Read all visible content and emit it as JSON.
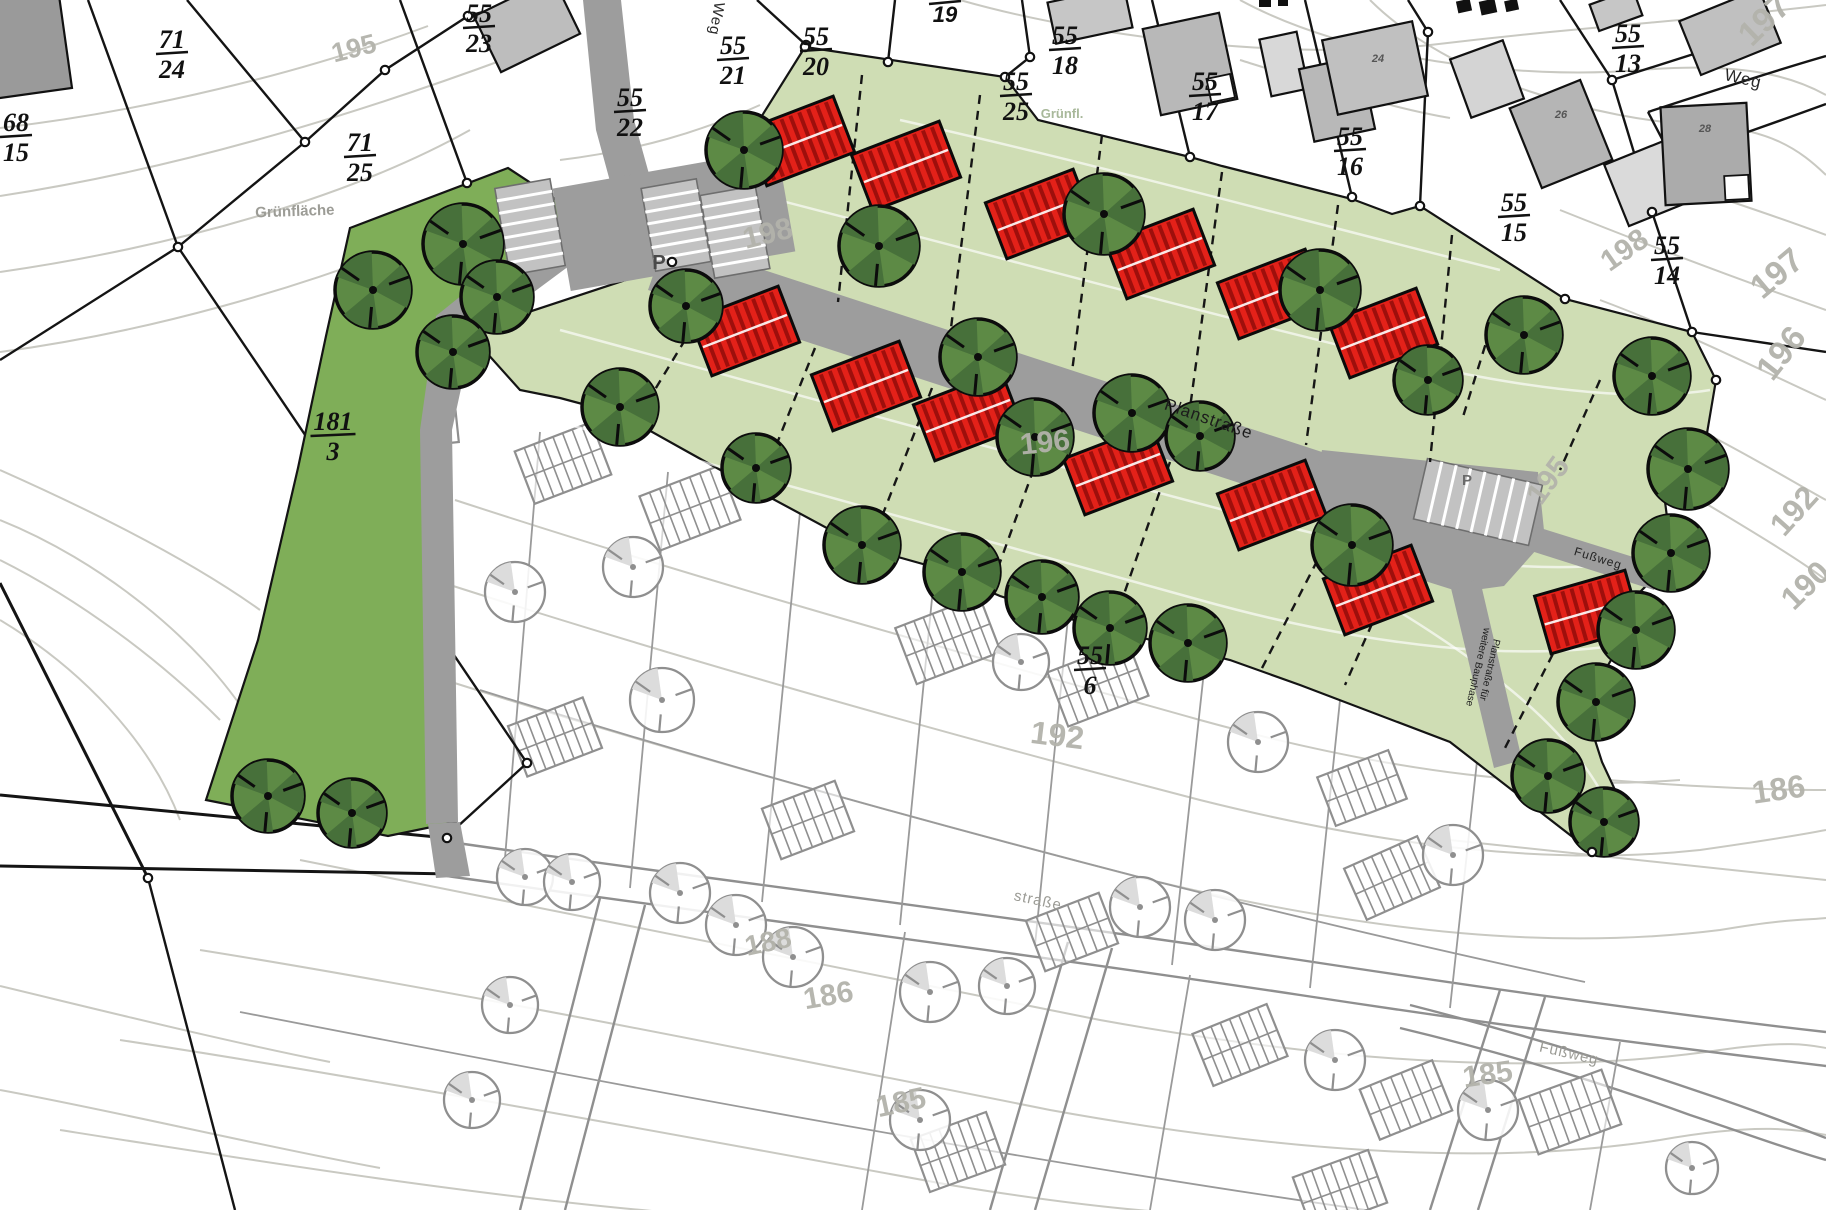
{
  "map": {
    "title": "Bebauungsplan Lageplan",
    "colors": {
      "area_light_green": "#cfddb4",
      "area_bright_green": "#7fae58",
      "tree_green": "#5d8a45",
      "tree_green_dark": "#47703a",
      "tree_existing_outline": "#8f8f8f",
      "house_red": "#e32119",
      "house_red_dark": "#9e0f0c",
      "road_gray": "#9d9d9d",
      "building_gray": "#b8b8b8",
      "contour_gray": "#c9c9c2",
      "contour_label_gray": "#b3b3ab",
      "boundary_black": "#141414"
    },
    "street_labels": [
      {
        "text": "Weg",
        "x": 712,
        "y": 18,
        "rot": 100,
        "size": 15,
        "color": "#2a2a2a"
      },
      {
        "text": "Weg",
        "x": 1742,
        "y": 84,
        "rot": 13,
        "size": 17,
        "color": "#2a2a2a"
      },
      {
        "text": "Planstraße",
        "x": 1207,
        "y": 424,
        "rot": 19,
        "size": 17,
        "color": "#1c1c1c"
      },
      {
        "text": "Fußweg",
        "x": 1597,
        "y": 562,
        "rot": 17,
        "size": 12,
        "color": "#222222"
      },
      {
        "text": "Fußweg",
        "x": 1568,
        "y": 1058,
        "rot": 13,
        "size": 15,
        "color": "#9b9b95"
      },
      {
        "text": "straße",
        "x": 1037,
        "y": 905,
        "rot": 12,
        "size": 15,
        "color": "#9b9b95"
      }
    ],
    "note_label": {
      "lines": [
        "Planstraße für",
        "weitere Bauphase"
      ],
      "x": 1482,
      "y": 668,
      "rot": 103,
      "size": 10,
      "color": "#1d1d1d"
    },
    "area_labels": [
      {
        "text": "Grünfläche",
        "x": 295,
        "y": 216,
        "rot": -2,
        "size": 15,
        "color": "#9c9c96"
      },
      {
        "text": "Grünfl.",
        "x": 1062,
        "y": 118,
        "rot": 0,
        "size": 13,
        "color": "#a8b89a"
      },
      {
        "text": "P",
        "x": 659,
        "y": 269,
        "rot": 0,
        "size": 20,
        "color": "#4a4a4a"
      },
      {
        "text": "P",
        "x": 1467,
        "y": 485,
        "rot": 0,
        "size": 15,
        "color": "#6a6a6a"
      }
    ],
    "contour_labels": [
      {
        "text": "195",
        "x": 356,
        "y": 57,
        "rot": -14,
        "size": 27
      },
      {
        "text": "198",
        "x": 770,
        "y": 243,
        "rot": -14,
        "size": 30
      },
      {
        "text": "196",
        "x": 1046,
        "y": 452,
        "rot": -6,
        "size": 30
      },
      {
        "text": "192",
        "x": 1056,
        "y": 746,
        "rot": 7,
        "size": 32
      },
      {
        "text": "197",
        "x": 1772,
        "y": 28,
        "rot": -44,
        "size": 34
      },
      {
        "text": "198",
        "x": 1630,
        "y": 258,
        "rot": -35,
        "size": 30
      },
      {
        "text": "197",
        "x": 1784,
        "y": 282,
        "rot": -40,
        "size": 34
      },
      {
        "text": "196",
        "x": 1790,
        "y": 360,
        "rot": -52,
        "size": 34
      },
      {
        "text": "195",
        "x": 1556,
        "y": 486,
        "rot": -54,
        "size": 30
      },
      {
        "text": "192",
        "x": 1802,
        "y": 518,
        "rot": -48,
        "size": 32
      },
      {
        "text": "190",
        "x": 1813,
        "y": 593,
        "rot": -44,
        "size": 32
      },
      {
        "text": "186",
        "x": 1780,
        "y": 800,
        "rot": -8,
        "size": 32
      },
      {
        "text": "185",
        "x": 1489,
        "y": 1084,
        "rot": -8,
        "size": 30
      },
      {
        "text": "188",
        "x": 770,
        "y": 951,
        "rot": -12,
        "size": 28
      },
      {
        "text": "186",
        "x": 830,
        "y": 1005,
        "rot": -10,
        "size": 30
      },
      {
        "text": "185",
        "x": 903,
        "y": 1112,
        "rot": -12,
        "size": 30
      }
    ],
    "parcel_labels": [
      {
        "num": "71",
        "den": "24",
        "x": 172,
        "y": 52
      },
      {
        "num": "68",
        "den": "15",
        "x": 16,
        "y": 135
      },
      {
        "num": "71",
        "den": "25",
        "x": 360,
        "y": 155
      },
      {
        "num": "55",
        "den": "23",
        "x": 479,
        "y": 26
      },
      {
        "num": "55",
        "den": "22",
        "x": 630,
        "y": 110
      },
      {
        "num": "55",
        "den": "21",
        "x": 733,
        "y": 58
      },
      {
        "num": "55",
        "den": "20",
        "x": 816,
        "y": 49
      },
      {
        "num": "55",
        "den": "18",
        "x": 1065,
        "y": 48
      },
      {
        "num": "55",
        "den": "25",
        "x": 1016,
        "y": 94
      },
      {
        "num": "55",
        "den": "17",
        "x": 1205,
        "y": 94
      },
      {
        "num": "55",
        "den": "16",
        "x": 1350,
        "y": 149
      },
      {
        "num": "55",
        "den": "15",
        "x": 1514,
        "y": 215
      },
      {
        "num": "55",
        "den": "13",
        "x": 1628,
        "y": 46
      },
      {
        "num": "55",
        "den": "14",
        "x": 1667,
        "y": 258
      },
      {
        "num": "55",
        "den": "6",
        "x": 1090,
        "y": 668
      },
      {
        "num": "181",
        "den": "3",
        "x": 333,
        "y": 434
      }
    ],
    "plain_labels": [
      {
        "text": "19",
        "x": 945,
        "y": 22,
        "size": 22,
        "color": "#111111",
        "bar_above": true
      },
      {
        "text": "24",
        "x": 1378,
        "y": 62,
        "size": 11,
        "color": "#555555"
      },
      {
        "text": "26",
        "x": 1561,
        "y": 118,
        "size": 11,
        "color": "#555555"
      },
      {
        "text": "28",
        "x": 1705,
        "y": 132,
        "size": 11,
        "color": "#555555"
      }
    ],
    "planned_houses": [
      {
        "x": 800,
        "y": 141,
        "rot": -21
      },
      {
        "x": 906,
        "y": 166,
        "rot": -21
      },
      {
        "x": 1040,
        "y": 214,
        "rot": -21
      },
      {
        "x": 1160,
        "y": 254,
        "rot": -21
      },
      {
        "x": 1272,
        "y": 294,
        "rot": -21
      },
      {
        "x": 1383,
        "y": 333,
        "rot": -21
      },
      {
        "x": 745,
        "y": 331,
        "rot": -21
      },
      {
        "x": 866,
        "y": 386,
        "rot": -21
      },
      {
        "x": 968,
        "y": 416,
        "rot": -21
      },
      {
        "x": 1118,
        "y": 470,
        "rot": -21
      },
      {
        "x": 1272,
        "y": 505,
        "rot": -21
      },
      {
        "x": 1378,
        "y": 590,
        "rot": -21
      },
      {
        "x": 1588,
        "y": 612,
        "rot": -16
      }
    ],
    "planned_trees": [
      {
        "x": 463,
        "y": 244,
        "r": 40
      },
      {
        "x": 497,
        "y": 297,
        "r": 36
      },
      {
        "x": 373,
        "y": 290,
        "r": 38
      },
      {
        "x": 453,
        "y": 352,
        "r": 36
      },
      {
        "x": 268,
        "y": 796,
        "r": 36
      },
      {
        "x": 352,
        "y": 813,
        "r": 34
      },
      {
        "x": 744,
        "y": 150,
        "r": 38
      },
      {
        "x": 879,
        "y": 246,
        "r": 40
      },
      {
        "x": 1104,
        "y": 214,
        "r": 40
      },
      {
        "x": 1320,
        "y": 290,
        "r": 40
      },
      {
        "x": 1524,
        "y": 335,
        "r": 38
      },
      {
        "x": 1428,
        "y": 380,
        "r": 34
      },
      {
        "x": 686,
        "y": 306,
        "r": 36
      },
      {
        "x": 620,
        "y": 407,
        "r": 38
      },
      {
        "x": 756,
        "y": 468,
        "r": 34
      },
      {
        "x": 862,
        "y": 545,
        "r": 38
      },
      {
        "x": 962,
        "y": 572,
        "r": 38
      },
      {
        "x": 1042,
        "y": 597,
        "r": 36
      },
      {
        "x": 1110,
        "y": 628,
        "r": 36
      },
      {
        "x": 1188,
        "y": 643,
        "r": 38
      },
      {
        "x": 978,
        "y": 357,
        "r": 38
      },
      {
        "x": 1035,
        "y": 437,
        "r": 38
      },
      {
        "x": 1132,
        "y": 413,
        "r": 38
      },
      {
        "x": 1200,
        "y": 436,
        "r": 34
      },
      {
        "x": 1352,
        "y": 545,
        "r": 40
      },
      {
        "x": 1652,
        "y": 376,
        "r": 38
      },
      {
        "x": 1688,
        "y": 469,
        "r": 40
      },
      {
        "x": 1671,
        "y": 553,
        "r": 38
      },
      {
        "x": 1636,
        "y": 630,
        "r": 38
      },
      {
        "x": 1596,
        "y": 702,
        "r": 38
      },
      {
        "x": 1548,
        "y": 776,
        "r": 36
      },
      {
        "x": 1604,
        "y": 822,
        "r": 34
      }
    ],
    "existing_trees": [
      {
        "x": 338,
        "y": 520,
        "r": 30
      },
      {
        "x": 515,
        "y": 592,
        "r": 30
      },
      {
        "x": 633,
        "y": 567,
        "r": 30
      },
      {
        "x": 662,
        "y": 700,
        "r": 32
      },
      {
        "x": 1021,
        "y": 662,
        "r": 28
      },
      {
        "x": 525,
        "y": 877,
        "r": 28
      },
      {
        "x": 572,
        "y": 882,
        "r": 28
      },
      {
        "x": 680,
        "y": 893,
        "r": 30
      },
      {
        "x": 736,
        "y": 925,
        "r": 30
      },
      {
        "x": 510,
        "y": 1005,
        "r": 28
      },
      {
        "x": 472,
        "y": 1100,
        "r": 28
      },
      {
        "x": 793,
        "y": 957,
        "r": 30
      },
      {
        "x": 930,
        "y": 992,
        "r": 30
      },
      {
        "x": 1007,
        "y": 986,
        "r": 28
      },
      {
        "x": 920,
        "y": 1120,
        "r": 30
      },
      {
        "x": 1140,
        "y": 907,
        "r": 30
      },
      {
        "x": 1215,
        "y": 920,
        "r": 30
      },
      {
        "x": 1258,
        "y": 742,
        "r": 30
      },
      {
        "x": 1453,
        "y": 855,
        "r": 30
      },
      {
        "x": 1335,
        "y": 1060,
        "r": 30
      },
      {
        "x": 1488,
        "y": 1110,
        "r": 30
      },
      {
        "x": 1692,
        "y": 1168,
        "r": 26
      }
    ],
    "existing_buildings": [
      {
        "x": 18,
        "y": 45,
        "w": 95,
        "h": 100,
        "rot": -8,
        "fill": "#9a9a9a"
      },
      {
        "x": 527,
        "y": 25,
        "w": 88,
        "h": 62,
        "rot": -26,
        "fill": "#bdbdbd"
      },
      {
        "x": 1090,
        "y": 15,
        "w": 78,
        "h": 42,
        "rot": -12,
        "fill": "#c6c6c6"
      },
      {
        "x": 1190,
        "y": 64,
        "w": 78,
        "h": 88,
        "rot": -12,
        "fill": "#b8b8b8",
        "notch": true
      },
      {
        "x": 1284,
        "y": 64,
        "w": 38,
        "h": 58,
        "rot": -12,
        "fill": "#d8d8d8"
      },
      {
        "x": 1337,
        "y": 99,
        "w": 62,
        "h": 74,
        "rot": -12,
        "fill": "#b8b8b8"
      },
      {
        "x": 1375,
        "y": 68,
        "w": 92,
        "h": 76,
        "rot": -12,
        "fill": "#c0c0c0"
      },
      {
        "x": 1487,
        "y": 79,
        "w": 56,
        "h": 62,
        "rot": -20,
        "fill": "#d4d4d4"
      },
      {
        "x": 1561,
        "y": 134,
        "w": 76,
        "h": 86,
        "rot": -22,
        "fill": "#b5b5b5"
      },
      {
        "x": 1650,
        "y": 182,
        "w": 72,
        "h": 66,
        "rot": -22,
        "fill": "#dadada"
      },
      {
        "x": 1706,
        "y": 154,
        "w": 86,
        "h": 98,
        "rot": -3,
        "fill": "#ababab",
        "notch": true
      },
      {
        "x": 1730,
        "y": 32,
        "w": 86,
        "h": 58,
        "rot": -22,
        "fill": "#c0c0c0"
      },
      {
        "x": 1616,
        "y": 10,
        "w": 46,
        "h": 28,
        "rot": -20,
        "fill": "#c6c6c6"
      }
    ],
    "hatched_buildings": [
      {
        "x": 428,
        "y": 407,
        "w": 54,
        "h": 76,
        "rot": -6
      },
      {
        "x": 396,
        "y": 548,
        "w": 54,
        "h": 80,
        "rot": -6
      },
      {
        "x": 360,
        "y": 710,
        "w": 54,
        "h": 80,
        "rot": -4
      },
      {
        "x": 563,
        "y": 463,
        "w": 82,
        "h": 56,
        "rot": -21
      },
      {
        "x": 690,
        "y": 508,
        "w": 86,
        "h": 58,
        "rot": -21
      },
      {
        "x": 948,
        "y": 640,
        "w": 90,
        "h": 60,
        "rot": -21
      },
      {
        "x": 1098,
        "y": 684,
        "w": 86,
        "h": 58,
        "rot": -21
      },
      {
        "x": 555,
        "y": 737,
        "w": 80,
        "h": 54,
        "rot": -21
      },
      {
        "x": 808,
        "y": 820,
        "w": 78,
        "h": 54,
        "rot": -21
      },
      {
        "x": 1362,
        "y": 788,
        "w": 76,
        "h": 52,
        "rot": -21
      },
      {
        "x": 1392,
        "y": 878,
        "w": 80,
        "h": 56,
        "rot": -24
      },
      {
        "x": 1072,
        "y": 932,
        "w": 78,
        "h": 54,
        "rot": -21
      },
      {
        "x": 1240,
        "y": 1045,
        "w": 80,
        "h": 56,
        "rot": -22
      },
      {
        "x": 1406,
        "y": 1100,
        "w": 78,
        "h": 54,
        "rot": -22
      },
      {
        "x": 1570,
        "y": 1112,
        "w": 88,
        "h": 58,
        "rot": -20
      },
      {
        "x": 958,
        "y": 1152,
        "w": 80,
        "h": 56,
        "rot": -20
      },
      {
        "x": 1340,
        "y": 1190,
        "w": 80,
        "h": 56,
        "rot": -20
      }
    ],
    "parking_rows": [
      {
        "x": 530,
        "y": 227,
        "w": 56,
        "h": 88,
        "rot": -10,
        "stripes": 7,
        "dir": "h"
      },
      {
        "x": 676,
        "y": 225,
        "w": 56,
        "h": 84,
        "rot": -10,
        "stripes": 7,
        "dir": "h"
      },
      {
        "x": 735,
        "y": 232,
        "w": 56,
        "h": 84,
        "rot": -10,
        "stripes": 7,
        "dir": "h"
      },
      {
        "x": 1478,
        "y": 502,
        "w": 118,
        "h": 62,
        "rot": 13,
        "stripes": 8,
        "dir": "v"
      }
    ],
    "boundary_markers": [
      [
        178,
        247
      ],
      [
        305,
        142
      ],
      [
        385,
        70
      ],
      [
        468,
        16
      ],
      [
        527,
        763
      ],
      [
        467,
        183
      ],
      [
        806,
        45
      ],
      [
        888,
        62
      ],
      [
        1030,
        57
      ],
      [
        1005,
        77
      ],
      [
        672,
        262
      ],
      [
        805,
        47
      ],
      [
        1190,
        157
      ],
      [
        1352,
        197
      ],
      [
        1420,
        206
      ],
      [
        1428,
        32
      ],
      [
        1612,
        80
      ],
      [
        1652,
        212
      ],
      [
        1692,
        332
      ],
      [
        1565,
        299
      ],
      [
        1716,
        380
      ],
      [
        1592,
        852
      ],
      [
        148,
        878
      ],
      [
        447,
        838
      ]
    ]
  }
}
